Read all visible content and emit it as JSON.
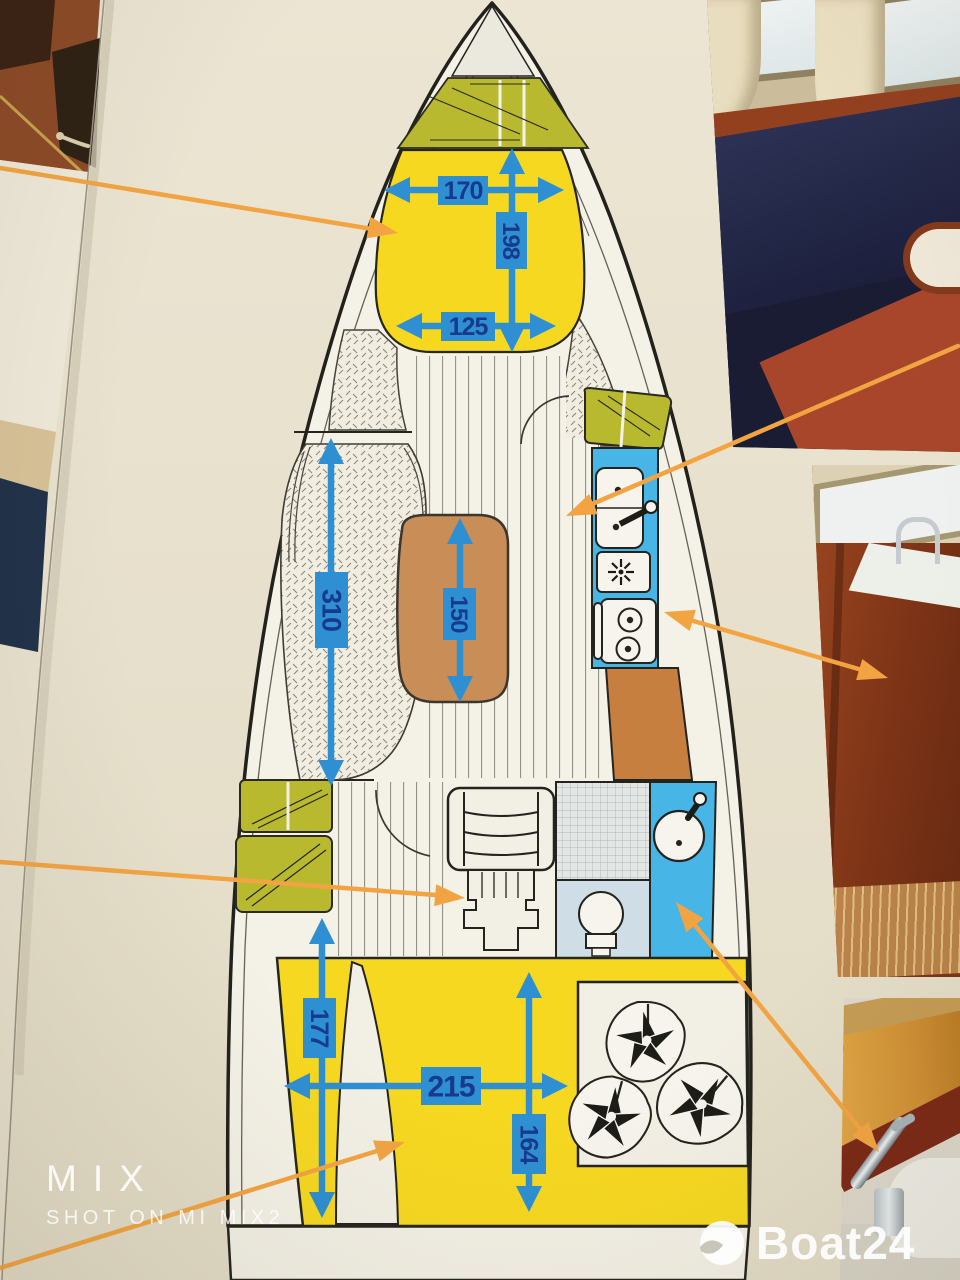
{
  "watermark": {
    "camera_line1": "MIX",
    "camera_line2": "SHOT ON MI MIX2"
  },
  "brand": {
    "logo_text": "Boat24"
  },
  "floorplan": {
    "measurements": {
      "v_berth_width": "170",
      "v_berth_length": "198",
      "v_berth_foot_width": "125",
      "saloon_length": "310",
      "saloon_table_length": "150",
      "aft_cabin_side_length": "177",
      "aft_berth_width": "215",
      "aft_berth_length": "164"
    },
    "colors": {
      "paper": "#e9e2cf",
      "hull_outline": "#23211b",
      "berth_yellow": "#f6d821",
      "locker_olive": "#b9b92f",
      "galley_blue": "#47b5e5",
      "dimension_blue": "#2e8fd2",
      "dimension_text": "#173a8c",
      "table_brown": "#c98d58",
      "counter_brown": "#c67f3e",
      "pointer_orange": "#f2a443"
    }
  }
}
